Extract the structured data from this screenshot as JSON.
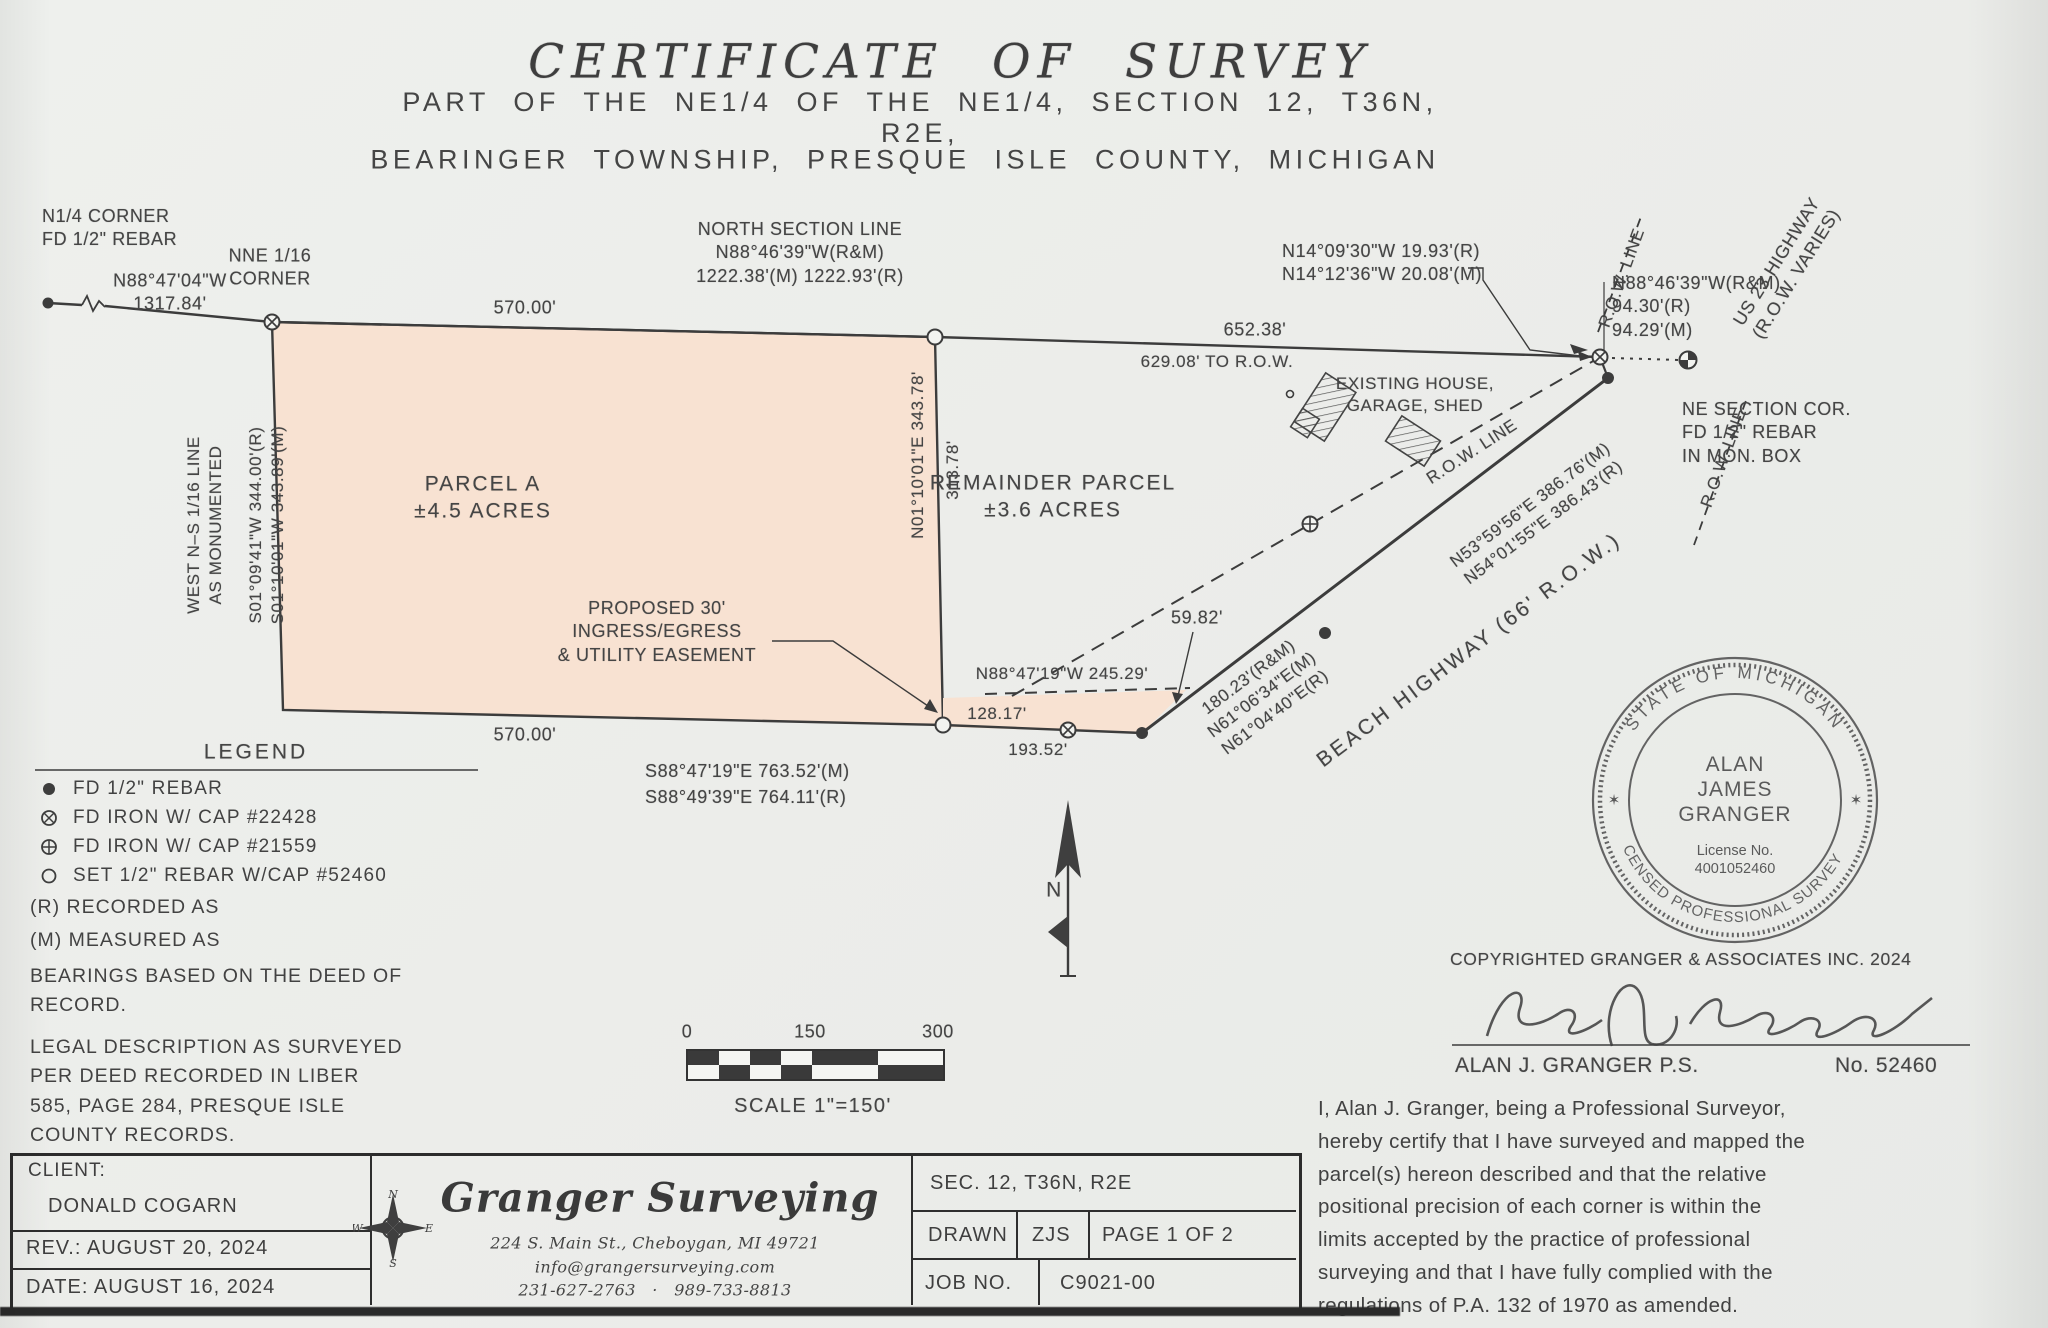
{
  "title": {
    "main": "CERTIFICATE OF SURVEY",
    "sub1": "PART OF THE NE1/4 OF THE NE1/4, SECTION 12, T36N, R2E,",
    "sub2": "BEARINGER TOWNSHIP, PRESQUE ISLE COUNTY, MICHIGAN"
  },
  "drawing": {
    "n_quarter_corner": "N1/4 CORNER\nFD 1/2\" REBAR",
    "brg_1317": "N88°47'04\"W\n1317.84'",
    "nne_corner": "NNE 1/16\nCORNER",
    "north_section_line": "NORTH SECTION LINE\nN88°46'39\"W(R&M)\n1222.38'(M)  1222.93'(R)",
    "top_570": "570.00'",
    "d_652": "652.38'",
    "d_629": "629.08'  TO  R.O.W.",
    "n14": "N14°09'30\"W    19.93'(R)\nN14°12'36\"W   20.08'(M)",
    "n88_94": "N88°46'39\"W(R&M)\n94.30'(R)\n94.29'(M)",
    "us23": "US 23 HIGHWAY\n(R.O.W. VARIES)",
    "ne_section_cor": "NE SECTION COR.\nFD 1/2\" REBAR\nIN MON. BOX",
    "existing_house": "EXISTING HOUSE,\nGARAGE, SHED",
    "row_line": "R.O.W. LINE",
    "parcel_a": "PARCEL A\n±4.5 ACRES",
    "remainder": "REMAINDER PARCEL\n±3.6 ACRES",
    "west_16_line": "WEST N–S 1/16 LINE\nAS MONUMENTED",
    "s01": "S01°09'41\"W  344.00'(R)\nS01°10'01\"W  343.89'(M)",
    "e_343": "N01°10'01\"E   343.78'",
    "e_313": "313.78'",
    "easement": "PROPOSED 30'\nINGRESS/EGRESS\n& UTILITY EASEMENT",
    "n88_245": "N88°47'19\"W  245.29'",
    "d_128": "128.17'",
    "d_5982": "59.82'",
    "bottom_570": "570.00'",
    "d_193": "193.52'",
    "s88": "S88°47'19\"E    763.52'(M)\nS88°49'39\"E    764.11'(R)",
    "d_180": "180.23'(R&M)\nN61°06'34\"E(M)\nN61°04'40\"E(R)",
    "beach_hwy": "BEACH  HIGHWAY  (66'  R.O.W.)",
    "n53": "N53°59'56\"E    386.76'(M)\nN54°01'55\"E    386.43'(R)"
  },
  "legend": {
    "heading": "LEGEND",
    "items": [
      {
        "symbol": "filled-circle-icon",
        "text": "FD 1/2\" REBAR"
      },
      {
        "symbol": "circle-x-icon",
        "text": "FD IRON W/ CAP #22428"
      },
      {
        "symbol": "circle-plus-icon",
        "text": "FD IRON W/ CAP #21559"
      },
      {
        "symbol": "open-circle-icon",
        "text": "SET 1/2\" REBAR W/CAP #52460"
      }
    ],
    "r_note": "(R) RECORDED AS",
    "m_note": "(M) MEASURED AS",
    "bearings_note": "BEARINGS BASED ON THE DEED OF\nRECORD.",
    "legal_note": "LEGAL DESCRIPTION AS SURVEYED\nPER DEED RECORDED IN LIBER\n585, PAGE 284, PRESQUE ISLE\nCOUNTY RECORDS."
  },
  "scale": {
    "zero": "0",
    "mid": "150",
    "max": "300",
    "caption": "SCALE  1\"=150'"
  },
  "north": {
    "letter": "N"
  },
  "stamp": {
    "arc_top": "STATE OF MICHIGAN",
    "star": "✶",
    "name": "ALAN\nJAMES\nGRANGER",
    "license": "License No.\n4001052460",
    "arc_bottom": "LICENSED PROFESSIONAL SURVEYOR"
  },
  "attest": {
    "copyright": "COPYRIGHTED  GRANGER  &  ASSOCIATES  INC.  2024",
    "name": "ALAN  J.  GRANGER    P.S.",
    "number": "No.  52460",
    "certification": "I, Alan J. Granger, being a Professional Surveyor,\nhereby certify that I have surveyed and mapped the\nparcel(s) hereon described and that the relative\npositional precision of each corner is within the\nlimits accepted by the practice of professional\nsurveying and that I have fully complied with the\nregulations of P.A. 132 of 1970 as amended."
  },
  "title_block": {
    "client_label": "CLIENT:",
    "client_name": "DONALD COGARN",
    "rev": "REV.: AUGUST 20, 2024",
    "date": "DATE: AUGUST 16, 2024",
    "firm": "Granger Surveying",
    "address": "224 S. Main St., Cheboygan, MI 49721",
    "email": "info@grangersurveying.com",
    "phones": "231-627-2763   ·   989-733-8813",
    "sec": "SEC. 12, T36N, R2E",
    "drawn_label": "DRAWN",
    "drawn_by": "ZJS",
    "page": "PAGE 1 OF 2",
    "job_label": "JOB NO.",
    "job_no": "C9021-00"
  },
  "compass": {
    "n": "N",
    "s": "S",
    "e": "E",
    "w": "W"
  },
  "colors": {
    "paper": "#edeeea",
    "ink": "#3f3f3f",
    "parcel_fill": "#f8e2d2"
  }
}
